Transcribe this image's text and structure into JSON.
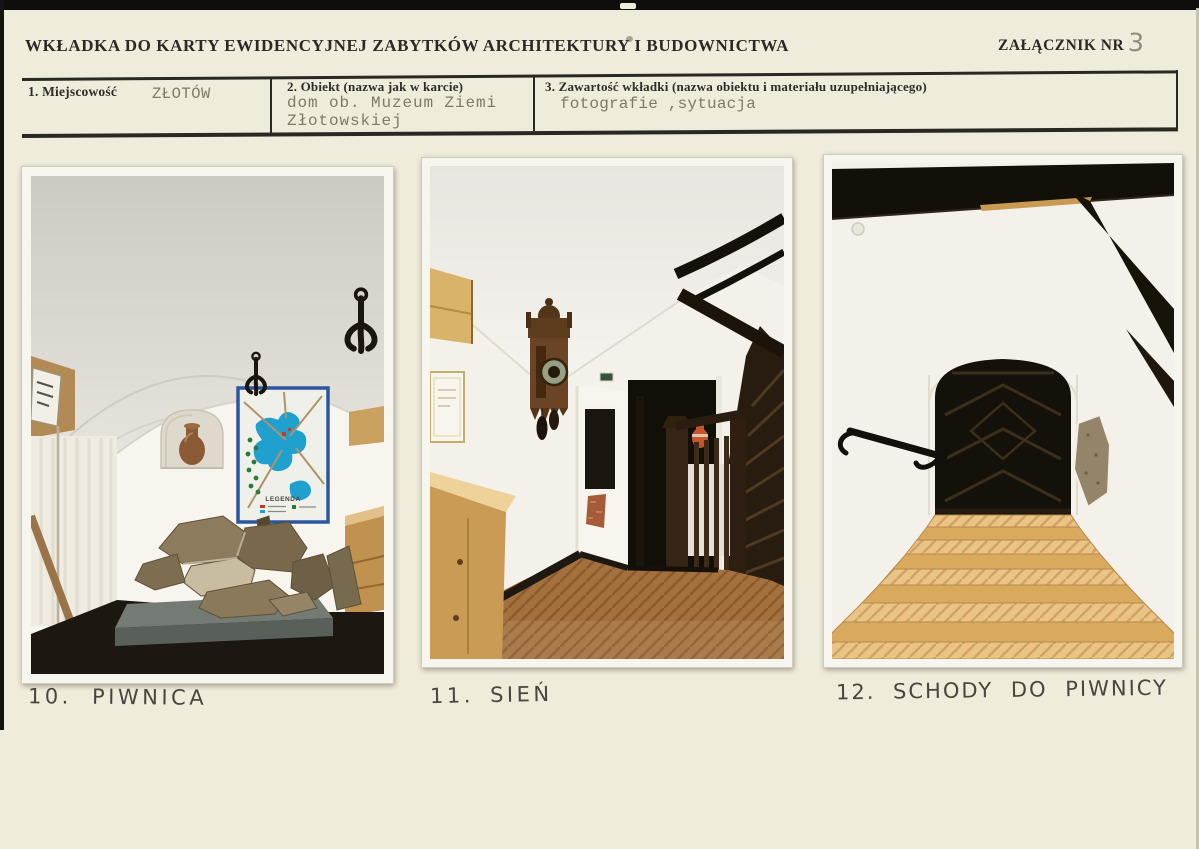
{
  "page": {
    "header": {
      "title": "WKŁADKA DO KARTY EWIDENCYJNEJ ZABYTKÓW ARCHITEKTURY I BUDOWNICTWA",
      "attachment_label": "ZAŁĄCZNIK NR",
      "attachment_number": "3"
    },
    "fields": [
      {
        "label": "1. Miejscowość",
        "value": "ZŁOTÓW"
      },
      {
        "label": "2. Obiekt (nazwa jak w karcie)",
        "value": "dom ob. Muzeum Ziemi\nZłotowskiej"
      },
      {
        "label": "3. Zawartość wkładki (nazwa obiektu i materiału uzupełniającego)",
        "value": "fotografie ,sytuacja"
      }
    ],
    "photos": [
      {
        "caption": "10. PIWNICA"
      },
      {
        "caption": "11. SIEŃ"
      },
      {
        "caption": "12. SCHODY DO PIWNICY"
      }
    ],
    "map": {
      "legend_label": "LEGENDA"
    },
    "colors": {
      "paper": "#f0ecdc",
      "print_ink": "#2b2925",
      "typewriter_ink": "#7e7968",
      "handwriting_ink": "#48463f",
      "photo_border": "#f6f5ee",
      "map_water_blue": "#1fa0cf",
      "map_frame_blue": "#2b57a0",
      "parquet_brown": "#a4713e",
      "stair_wood_light": "#e9c486",
      "dark_wood": "#241810"
    }
  }
}
